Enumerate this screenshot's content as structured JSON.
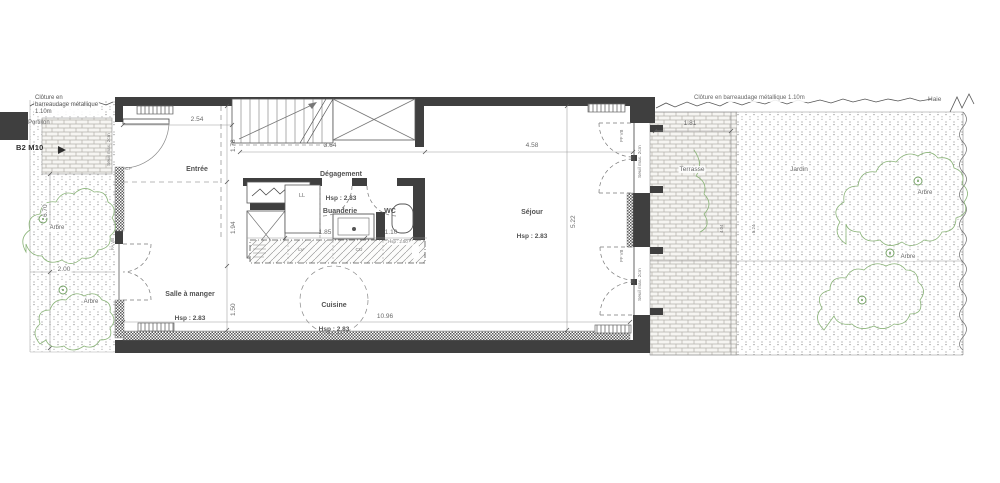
{
  "site": {
    "cloture_left": "Clôture en\nbarreaudage métallique\n1.10m",
    "cloture_right": "Clôture en barreaudage métallique 1.10m",
    "portillon": "Portillon",
    "plan_marker": "B2 M10",
    "haie": "Haie",
    "terrasse": "Terrasse",
    "jardin": "Jardin",
    "arbre": "Arbre"
  },
  "rooms": {
    "entree": {
      "label": "Entrée"
    },
    "degagement": {
      "label": "Dégagement",
      "hsp": "Hsp : 2.83"
    },
    "buanderie": {
      "label": "Buanderie"
    },
    "wc": {
      "label": "WC"
    },
    "sejour": {
      "label": "Séjour",
      "hsp": "Hsp : 2.83"
    },
    "salle_a_manger": {
      "label": "Salle à manger",
      "hsp": "Hsp : 2.83"
    },
    "cuisine": {
      "label": "Cuisine",
      "hsp": "Hsp : 2.83"
    }
  },
  "fixtures": {
    "ll": "LL",
    "lv": "LV",
    "cu": "CU",
    "cp": "CP",
    "counter_hsp": "Hsp : 2.50",
    "pf_vb": "PF VB",
    "fa_vb": "FA VB",
    "seuil": "Seuil max. 2cm"
  },
  "dimensions": {
    "entree_width": "2.54",
    "entree_depth": "1.78",
    "middle_depth": "1.94",
    "bottom_depth": "1.50",
    "degagement_width": "3.64",
    "sejour_width": "4.58",
    "sejour_depth": "5.22",
    "buanderie_width": "1.85",
    "wc_width": "1.10",
    "total_width": "10.96",
    "garden_left_width": "2.00",
    "garden_left_depth": "6.70",
    "terrasse_width": "1.81",
    "terrasse_depth": "4.04",
    "jardin_width": "5.24"
  }
}
